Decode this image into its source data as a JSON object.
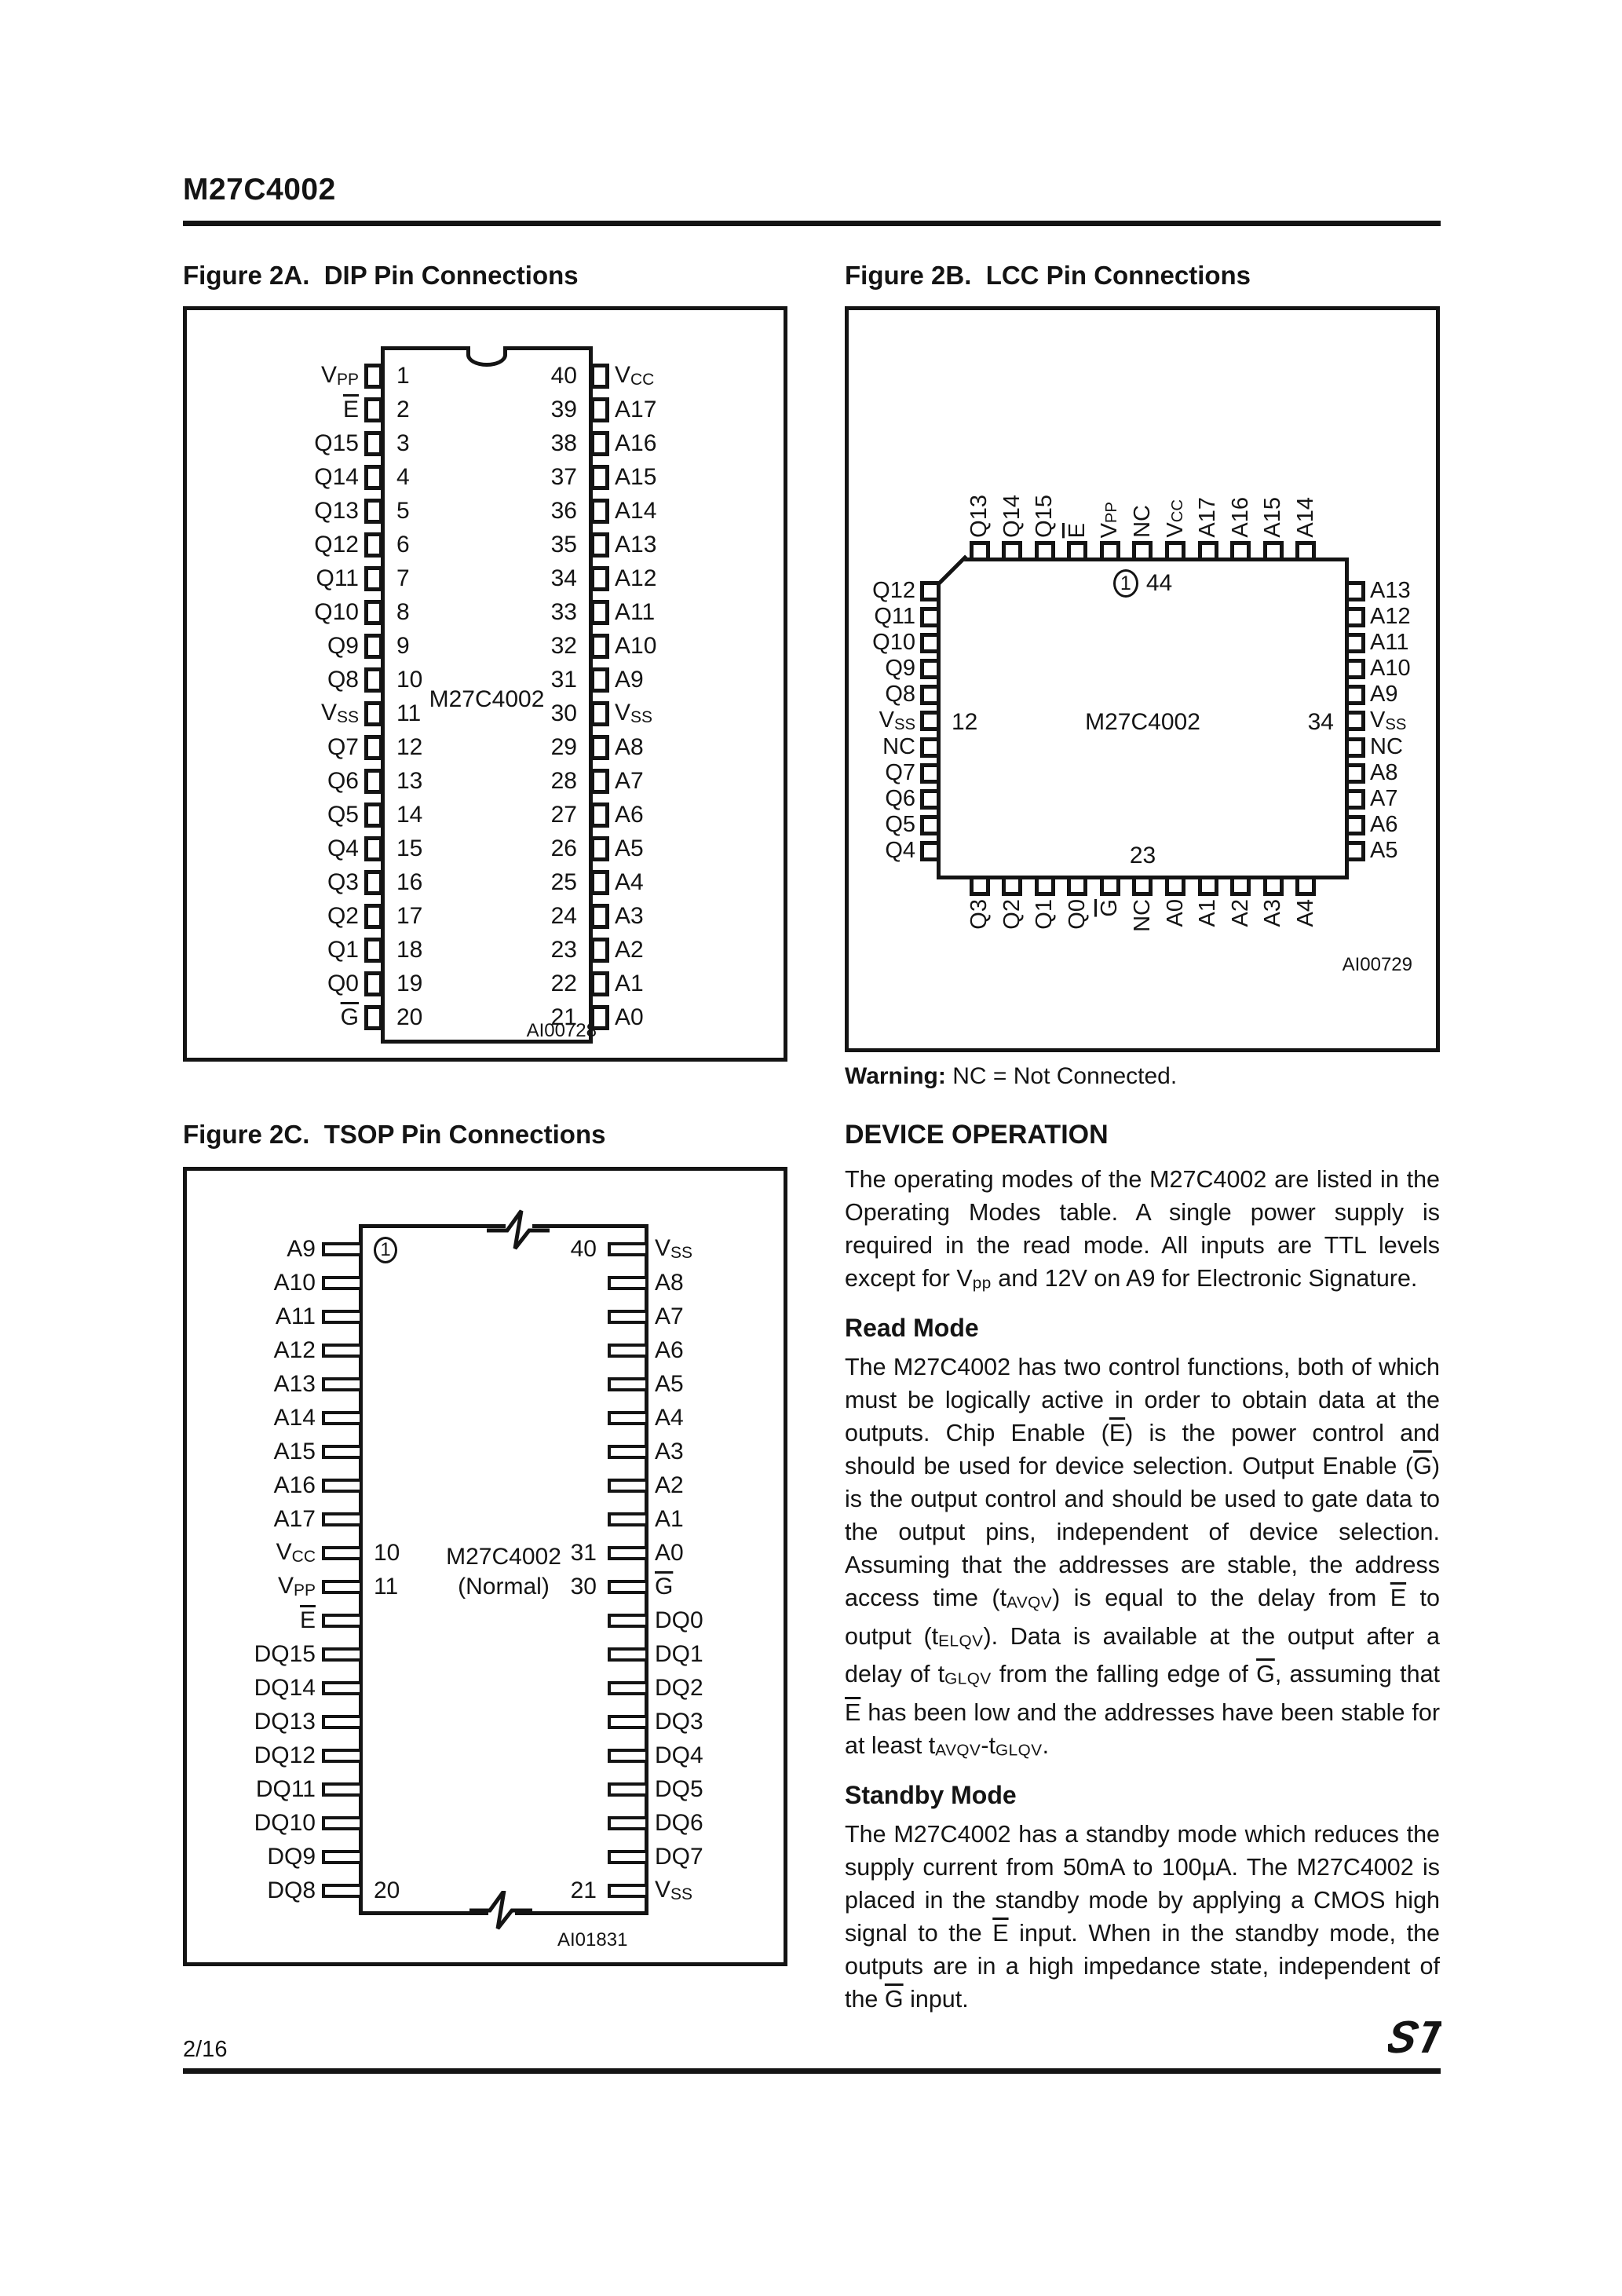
{
  "page": {
    "title": "M27C4002",
    "page_number": "2/16"
  },
  "fig2a": {
    "title": "Figure 2A.  DIP Pin Connections",
    "chip": "M27C4002",
    "note": "AI00728",
    "pins": [
      {
        "ln": "1",
        "left": "V_PP",
        "rn": "40",
        "right": "V_CC"
      },
      {
        "ln": "2",
        "left": "~E",
        "rn": "39",
        "right": "A17"
      },
      {
        "ln": "3",
        "left": "Q15",
        "rn": "38",
        "right": "A16"
      },
      {
        "ln": "4",
        "left": "Q14",
        "rn": "37",
        "right": "A15"
      },
      {
        "ln": "5",
        "left": "Q13",
        "rn": "36",
        "right": "A14"
      },
      {
        "ln": "6",
        "left": "Q12",
        "rn": "35",
        "right": "A13"
      },
      {
        "ln": "7",
        "left": "Q11",
        "rn": "34",
        "right": "A12"
      },
      {
        "ln": "8",
        "left": "Q10",
        "rn": "33",
        "right": "A11"
      },
      {
        "ln": "9",
        "left": "Q9",
        "rn": "32",
        "right": "A10"
      },
      {
        "ln": "10",
        "left": "Q8",
        "rn": "31",
        "right": "A9"
      },
      {
        "ln": "11",
        "left": "V_SS",
        "rn": "30",
        "right": "V_SS"
      },
      {
        "ln": "12",
        "left": "Q7",
        "rn": "29",
        "right": "A8"
      },
      {
        "ln": "13",
        "left": "Q6",
        "rn": "28",
        "right": "A7"
      },
      {
        "ln": "14",
        "left": "Q5",
        "rn": "27",
        "right": "A6"
      },
      {
        "ln": "15",
        "left": "Q4",
        "rn": "26",
        "right": "A5"
      },
      {
        "ln": "16",
        "left": "Q3",
        "rn": "25",
        "right": "A4"
      },
      {
        "ln": "17",
        "left": "Q2",
        "rn": "24",
        "right": "A3"
      },
      {
        "ln": "18",
        "left": "Q1",
        "rn": "23",
        "right": "A2"
      },
      {
        "ln": "19",
        "left": "Q0",
        "rn": "22",
        "right": "A1"
      },
      {
        "ln": "20",
        "left": "~G",
        "rn": "21",
        "right": "A0"
      }
    ]
  },
  "fig2b": {
    "title": "Figure 2B.  LCC Pin Connections",
    "chip": "M27C4002",
    "note": "AI00729",
    "marker_pin1": "1",
    "marker_pin44": "44",
    "marker_left": "12",
    "marker_right": "34",
    "marker_bottom": "23",
    "top_pins": [
      "Q13",
      "Q14",
      "Q15",
      "~E",
      "V_PP",
      "NC",
      "V_CC",
      "A17",
      "A16",
      "A15",
      "A14"
    ],
    "left_pins": [
      "Q12",
      "Q11",
      "Q10",
      "Q9",
      "Q8",
      "V_SS",
      "NC",
      "Q7",
      "Q6",
      "Q5",
      "Q4"
    ],
    "right_pins": [
      "A13",
      "A12",
      "A11",
      "A10",
      "A9",
      "V_SS",
      "NC",
      "A8",
      "A7",
      "A6",
      "A5"
    ],
    "bottom_pins": [
      "Q3",
      "Q2",
      "Q1",
      "Q0",
      "~G",
      "NC",
      "A0",
      "A1",
      "A2",
      "A3",
      "A4"
    ],
    "warning_bold": "Warning:",
    "warning_rest": " NC = Not Connected."
  },
  "fig2c": {
    "title": "Figure 2C.  TSOP Pin Connections",
    "chip_line1": "M27C4002",
    "chip_line2": "(Normal)",
    "note": "AI01831",
    "pins": [
      {
        "lnum": "1",
        "lcirc": true,
        "left": "A9",
        "rnum": "40",
        "right": "V_SS"
      },
      {
        "left": "A10",
        "right": "A8"
      },
      {
        "left": "A11",
        "right": "A7"
      },
      {
        "left": "A12",
        "right": "A6"
      },
      {
        "left": "A13",
        "right": "A5"
      },
      {
        "left": "A14",
        "right": "A4"
      },
      {
        "left": "A15",
        "right": "A3"
      },
      {
        "left": "A16",
        "right": "A2"
      },
      {
        "left": "A17",
        "right": "A1"
      },
      {
        "lnum": "10",
        "left": "V_CC",
        "rnum": "31",
        "right": "A0"
      },
      {
        "lnum": "11",
        "left": "V_PP",
        "rnum": "30",
        "right": "~G"
      },
      {
        "left": "~E",
        "right": "DQ0"
      },
      {
        "left": "DQ15",
        "right": "DQ1"
      },
      {
        "left": "DQ14",
        "right": "DQ2"
      },
      {
        "left": "DQ13",
        "right": "DQ3"
      },
      {
        "left": "DQ12",
        "right": "DQ4"
      },
      {
        "left": "DQ11",
        "right": "DQ5"
      },
      {
        "left": "DQ10",
        "right": "DQ6"
      },
      {
        "left": "DQ9",
        "right": "DQ7"
      },
      {
        "lnum": "20",
        "left": "DQ8",
        "rnum": "21",
        "right": "V_SS"
      }
    ]
  },
  "device_operation": {
    "heading": "DEVICE OPERATION",
    "intro": [
      {
        "t": "The operating modes of the M27C4002 are listed in the Operating Modes table. A single power supply is required in the read mode.  All inputs are TTL levels except for V"
      },
      {
        "t": "pp",
        "s": 1
      },
      {
        "t": " and 12V on A9 for Electronic Signature."
      }
    ],
    "read_heading": "Read Mode",
    "read": [
      {
        "t": "The M27C4002 has two control functions, both of which must be logically active in order to obtain data at the outputs.  Chip Enable ("
      },
      {
        "t": "E",
        "o": 1
      },
      {
        "t": ") is the power control and should be used for device selection. Output Enable ("
      },
      {
        "t": "G",
        "o": 1
      },
      {
        "t": ") is the output control and should be used to gate data to the output pins, independent of device selection.  Assuming that the addresses are stable, the address access time (t"
      },
      {
        "t": "AVQV",
        "s": 1
      },
      {
        "t": ") is equal to the delay from "
      },
      {
        "t": "E",
        "o": 1
      },
      {
        "t": " to output (t"
      },
      {
        "t": "ELQV",
        "s": 1
      },
      {
        "t": "). Data is available at the output after a delay of t"
      },
      {
        "t": "GLQV",
        "s": 1
      },
      {
        "t": " from the falling edge of "
      },
      {
        "t": "G",
        "o": 1
      },
      {
        "t": ", assuming that "
      },
      {
        "t": "E",
        "o": 1
      },
      {
        "t": " has been low and the addresses have been stable for at least t"
      },
      {
        "t": "AVQV",
        "s": 1
      },
      {
        "t": "-t"
      },
      {
        "t": "GLQV",
        "s": 1
      },
      {
        "t": "."
      }
    ],
    "standby_heading": "Standby Mode",
    "standby": [
      {
        "t": "The M27C4002 has a standby mode which reduces the supply current from 50mA to 100µA. The M27C4002 is placed in the standby mode by applying a CMOS high signal to the "
      },
      {
        "t": "E",
        "o": 1
      },
      {
        "t": " input.  When in the standby mode, the outputs are in a high impedance state, independent of the "
      },
      {
        "t": "G",
        "o": 1
      },
      {
        "t": " input."
      }
    ]
  }
}
